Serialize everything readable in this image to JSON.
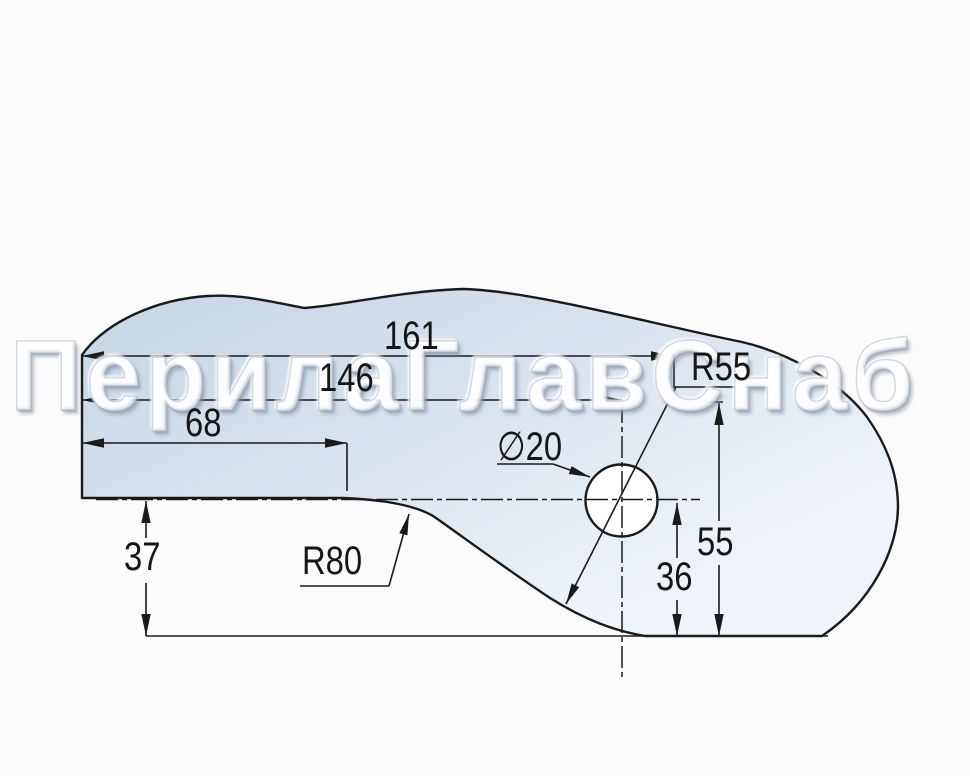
{
  "watermark": {
    "text": "ПерилаГлавСнаб"
  },
  "drawing": {
    "dimensions": {
      "overall_length": "161",
      "hole_center_from_left": "146",
      "flat_bottom_length": "68",
      "outer_radius_label": "R55",
      "hole_diameter_label": "∅20",
      "arc_center_height": "55",
      "hole_center_height": "36",
      "left_step_height": "37",
      "cove_radius_label": "R80"
    },
    "colors": {
      "line": "#1a1a1a",
      "part_fill_dark": "#c6d4e3",
      "part_fill_mid": "#d9e3ee",
      "part_fill_light": "#eef4f9",
      "hole_fill": "#ffffff",
      "background": "#fbfbfb",
      "watermark_text": "#ffffff"
    }
  }
}
